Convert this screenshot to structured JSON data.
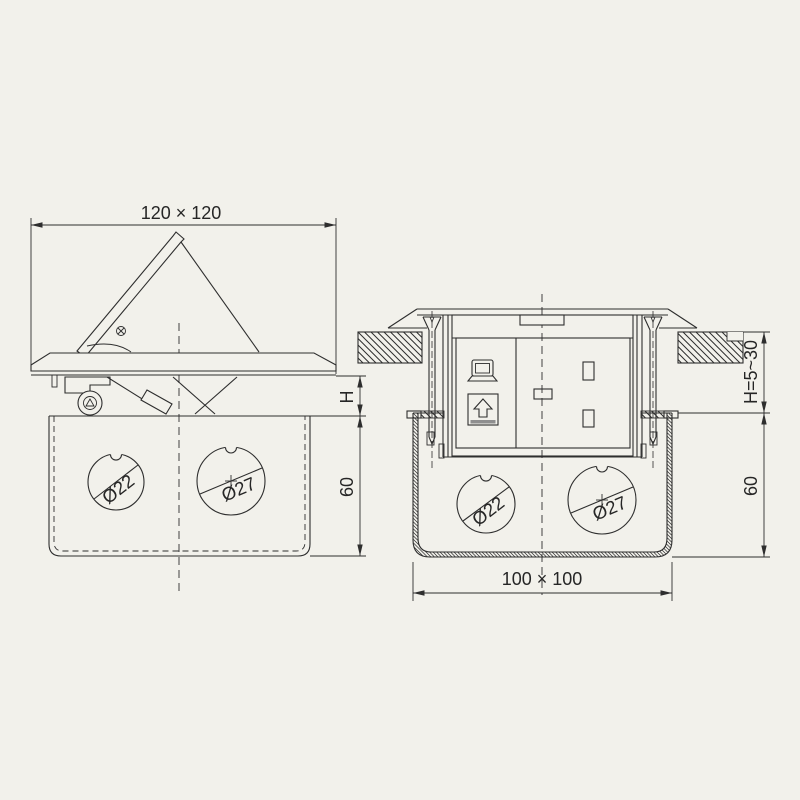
{
  "title": "pop-up-floor-socket-box-technical-drawing",
  "colors": {
    "background": "#f2f1eb",
    "line": "#2e2e2e",
    "button_shadow": "#8f8f8f"
  },
  "left_view": {
    "name": "side-view-lid-open",
    "dim_top": "120 × 120",
    "dim_h": "H",
    "dim_depth": "60",
    "hole_small": "Ø22",
    "hole_large": "Ø27"
  },
  "right_view": {
    "name": "installed-section-view",
    "dim_h_range": "H=5~30",
    "dim_depth": "60",
    "dim_bottom": "100 × 100",
    "hole_small": "Ø22",
    "hole_large": "Ø27",
    "icons": [
      "laptop-icon",
      "eject-arrow-icon",
      "screw-icon",
      "floor-hatch"
    ]
  }
}
